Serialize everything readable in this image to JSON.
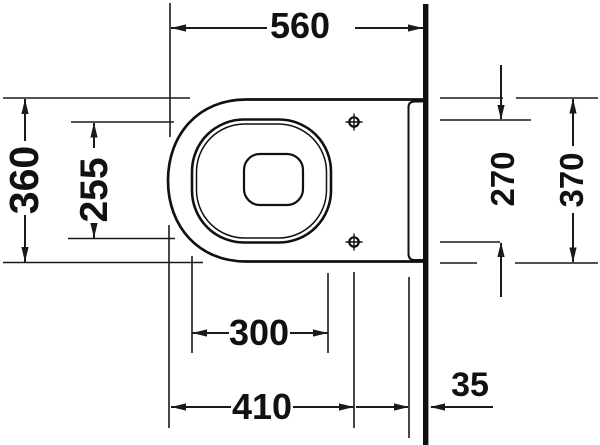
{
  "drawing": {
    "title": "Technical dimension drawing, wall-hung toilet, plan view",
    "background_color": "#ffffff",
    "line_color": "#1a1a1a",
    "labels": {
      "top": "560",
      "left_outer": "360",
      "left_inner": "255",
      "right_inner": "270",
      "right_outer": "370",
      "bottom_inner": "300",
      "bottom_middle": "410",
      "bottom_right": "35"
    }
  }
}
